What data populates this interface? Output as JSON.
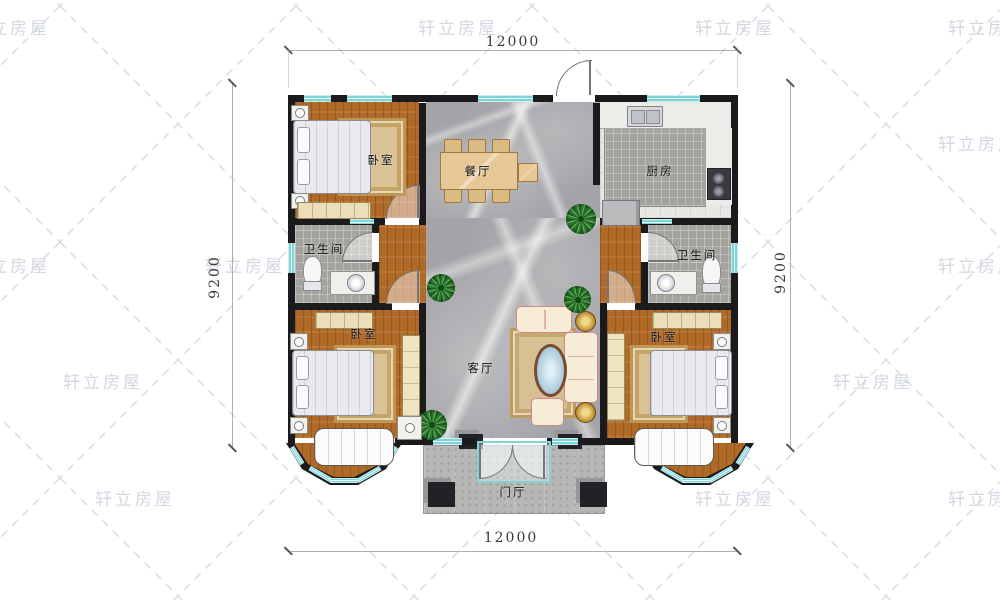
{
  "watermark": {
    "text": "轩立房屋",
    "positions": [
      [
        -30,
        14
      ],
      [
        418,
        14
      ],
      [
        695,
        14
      ],
      [
        948,
        14
      ],
      [
        938,
        130
      ],
      [
        -30,
        252
      ],
      [
        205,
        252
      ],
      [
        938,
        252
      ],
      [
        63,
        368
      ],
      [
        328,
        368
      ],
      [
        560,
        368
      ],
      [
        833,
        368
      ],
      [
        95,
        485
      ],
      [
        448,
        485
      ],
      [
        695,
        485
      ],
      [
        948,
        485
      ]
    ]
  },
  "dimensions": {
    "top": "12000",
    "bottom": "12000",
    "left": "9200",
    "right": "9200"
  },
  "rooms": {
    "bedroom_top_left": {
      "label": "卧室"
    },
    "dining": {
      "label": "餐厅"
    },
    "kitchen": {
      "label": "厨房"
    },
    "bath_left": {
      "label": "卫生间"
    },
    "bath_right": {
      "label": "卫生间"
    },
    "living": {
      "label": "客厅"
    },
    "bedroom_bottom_left": {
      "label": "卧室"
    },
    "bedroom_bottom_right": {
      "label": "卧室"
    },
    "foyer": {
      "label": "门厅"
    }
  },
  "colors": {
    "wall": "#1b1b1d",
    "window_cyan": "#7fd4d8",
    "wood_floor": "#b06a28",
    "marble_floor": "#a4a4a8",
    "watermark_gray": "#ccd1dc",
    "plant_green": "#2e7d32"
  }
}
